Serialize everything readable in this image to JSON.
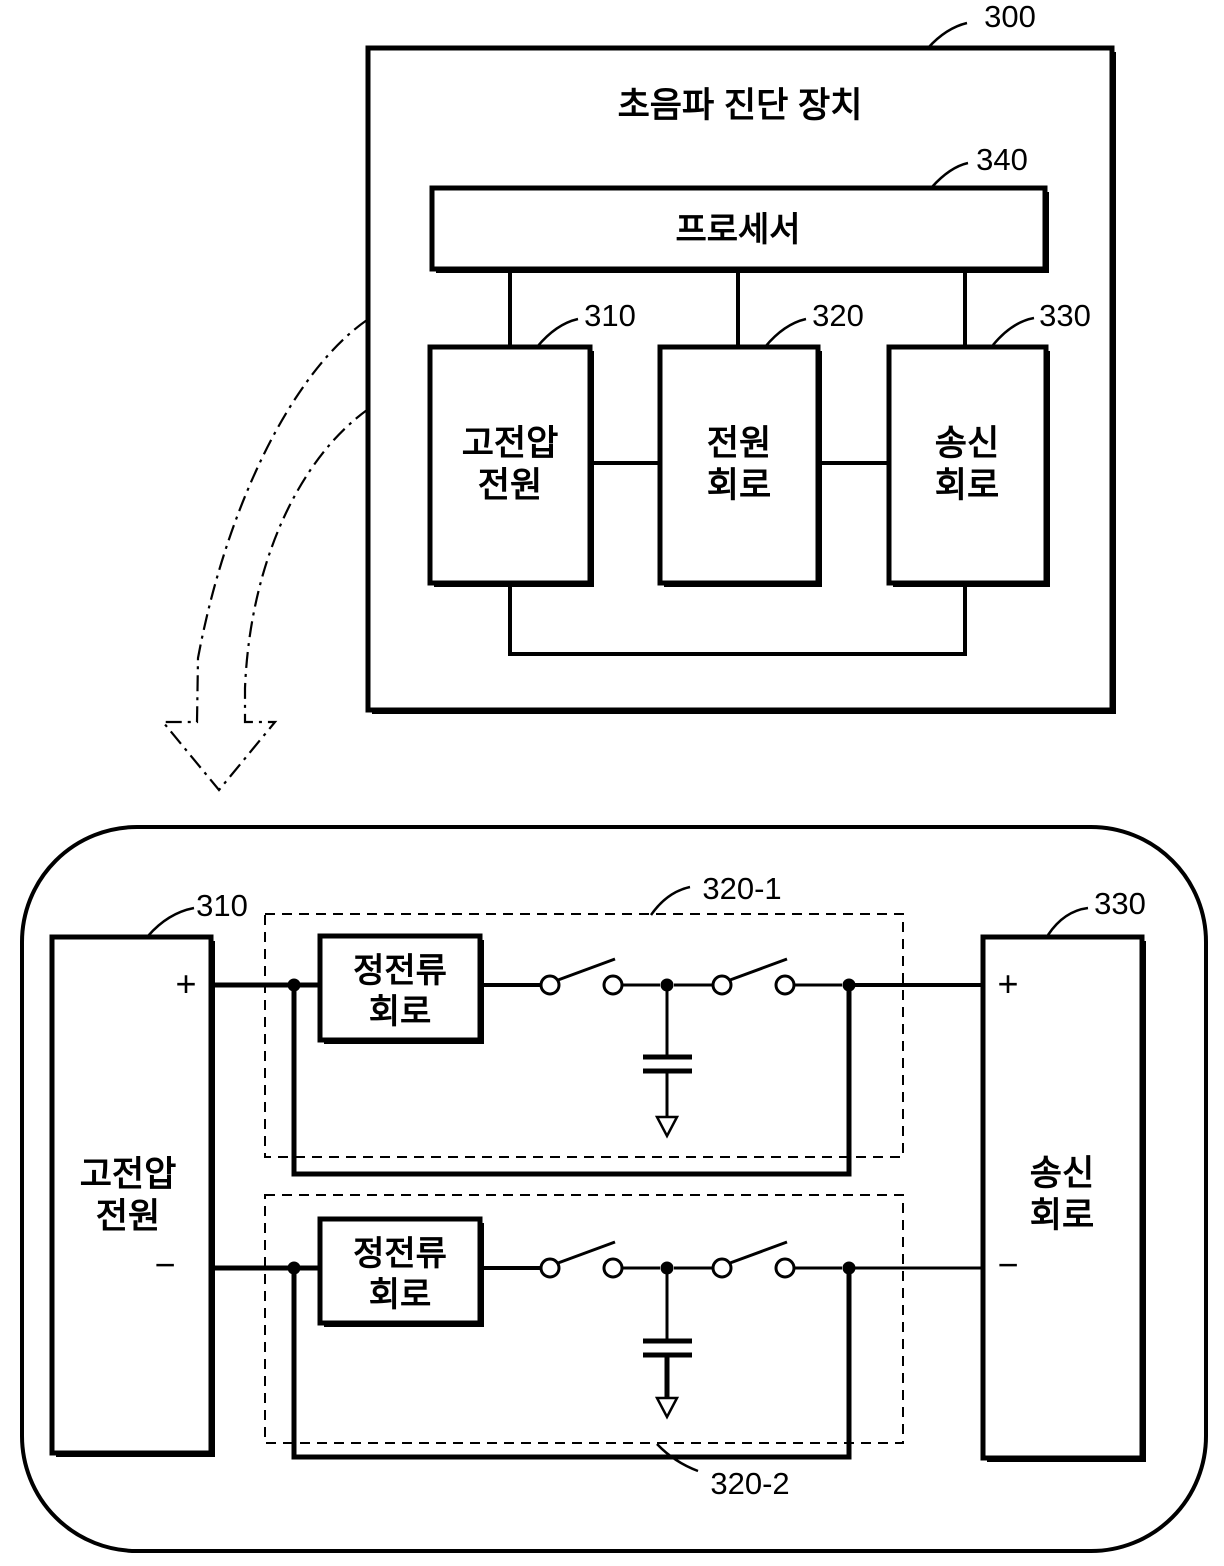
{
  "colors": {
    "ink": "#000000",
    "paper": "#ffffff"
  },
  "top_diagram": {
    "ref": "300",
    "title": "초음파 진단 장치",
    "processor": {
      "ref": "340",
      "label": "프로세서"
    },
    "blocks": [
      {
        "ref": "310",
        "line1": "고전압",
        "line2": "전원"
      },
      {
        "ref": "320",
        "line1": "전원",
        "line2": "회로"
      },
      {
        "ref": "330",
        "line1": "송신",
        "line2": "회로"
      }
    ]
  },
  "bottom_diagram": {
    "hv_supply": {
      "ref": "310",
      "line1": "고전압",
      "line2": "전원",
      "plus": "+",
      "minus": "−"
    },
    "channel1": {
      "ref": "320-1",
      "cc_line1": "정전류",
      "cc_line2": "회로"
    },
    "channel2": {
      "ref": "320-2",
      "cc_line1": "정전류",
      "cc_line2": "회로"
    },
    "tx_circuit": {
      "ref": "330",
      "line1": "송신",
      "line2": "회로",
      "plus": "+",
      "minus": "−"
    }
  }
}
